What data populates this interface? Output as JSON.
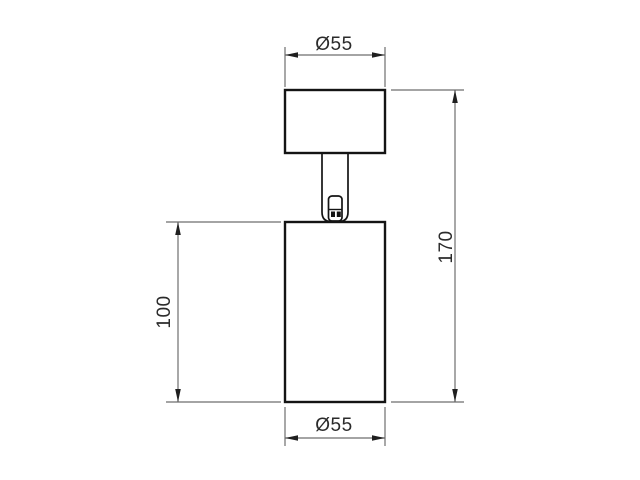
{
  "drawing": {
    "type": "technical-dimension-drawing",
    "labels": {
      "top_diameter": "Ø55",
      "bottom_diameter": "Ø55",
      "body_height": "100",
      "overall_height": "170"
    },
    "colors": {
      "background": "#ffffff",
      "object_line": "#141414",
      "dimension_line": "#6e6e6e",
      "arrow": "#1f1f1f",
      "text": "#2b2b2b"
    }
  }
}
